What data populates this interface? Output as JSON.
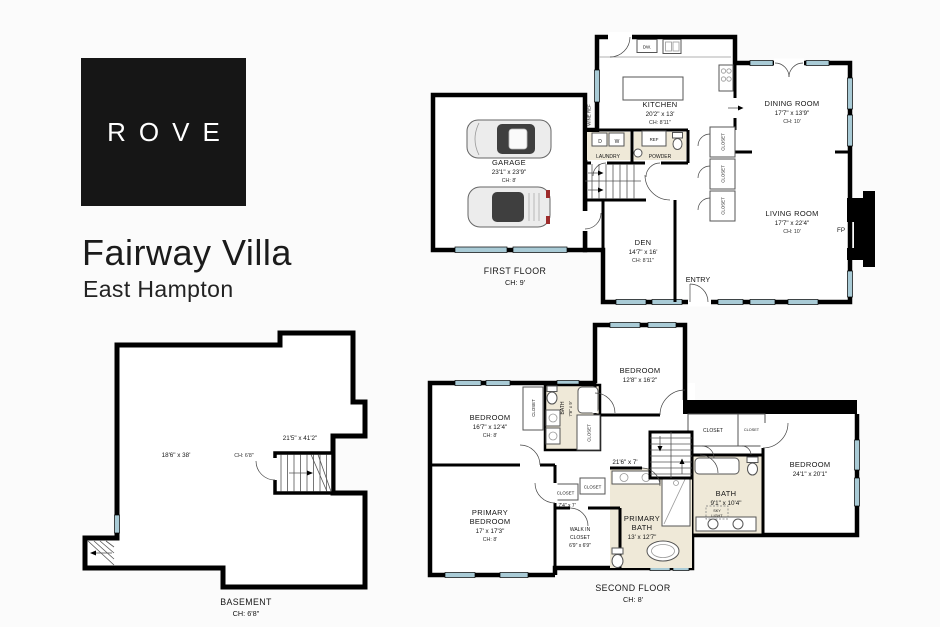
{
  "brand": {
    "logo_text": "ROVE"
  },
  "listing": {
    "title": "Fairway Villa",
    "subtitle": "East Hampton"
  },
  "colors": {
    "wall": "#000000",
    "window": "#a9cbd6",
    "bath_floor": "#efe9d8",
    "logo_background": "#161616",
    "page_background": "#fbfbfb"
  },
  "first_floor": {
    "title": "FIRST FLOOR",
    "ceiling": "CH: 9'",
    "garage": {
      "name": "GARAGE",
      "dims": "23'1\" x 23'9\"",
      "ch": "CH: 8'"
    },
    "kitchen": {
      "name": "KITCHEN",
      "dims": "20'2\" x 13'",
      "ch": "CH: 8'11\""
    },
    "dining_room": {
      "name": "DINING ROOM",
      "dims": "17'7\" x 13'9\"",
      "ch": "CH: 10'"
    },
    "living_room": {
      "name": "LIVING ROOM",
      "dims": "17'7\" x 22'4\"",
      "ch": "CH: 10'"
    },
    "den": {
      "name": "DEN",
      "dims": "14'7\" x 16'",
      "ch": "CH: 8'11\""
    },
    "labels": {
      "laundry": "LAUNDRY",
      "powder": "POWDER",
      "entry": "ENTRY",
      "fireplace": "FP",
      "wine_ref": "WINE REF",
      "ref": "REF",
      "dw": "DW.",
      "dryer": "D",
      "washer": "W",
      "closet": "CLOSET"
    }
  },
  "basement": {
    "title": "BASEMENT",
    "ceiling": "CH: 6'8\"",
    "main_dims": "18'6\" x 38'",
    "main_ch": "CH: 6'8\"",
    "stair_dims": "21'5\" x 41'2\""
  },
  "second_floor": {
    "title": "SECOND FLOOR",
    "ceiling": "CH: 8'",
    "bedroom_top": {
      "name": "BEDROOM",
      "dims": "12'8\" x 16'2\""
    },
    "bedroom_left": {
      "name": "BEDROOM",
      "dims": "16'7\" x 12'4\"",
      "ch": "CH: 8'"
    },
    "bedroom_right": {
      "name": "BEDROOM",
      "dims": "24'1\" x 20'1\""
    },
    "bath_hall": {
      "name": "BATH",
      "dims": "7'8\" x 9'"
    },
    "bath_ensuite": {
      "name": "BATH",
      "dims": "9'1\" x 10'4\""
    },
    "primary_bath": {
      "line1": "PRIMARY",
      "line2": "BATH",
      "dims": "13' x 12'7\""
    },
    "primary_bedroom": {
      "line1": "PRIMARY",
      "line2": "BEDROOM",
      "dims": "17' x 17'3\"",
      "ch": "CH: 8'"
    },
    "walk_in_closet": {
      "line1": "WALK IN",
      "line2": "CLOSET",
      "dims": "6'9\" x 6'9\""
    },
    "hall_dims": "21'6\" x 7'",
    "closet_dims": "7'4\" x 7'",
    "labels": {
      "closet": "CLOSET",
      "sky1": "SKY",
      "sky2": "LIGHT"
    }
  }
}
